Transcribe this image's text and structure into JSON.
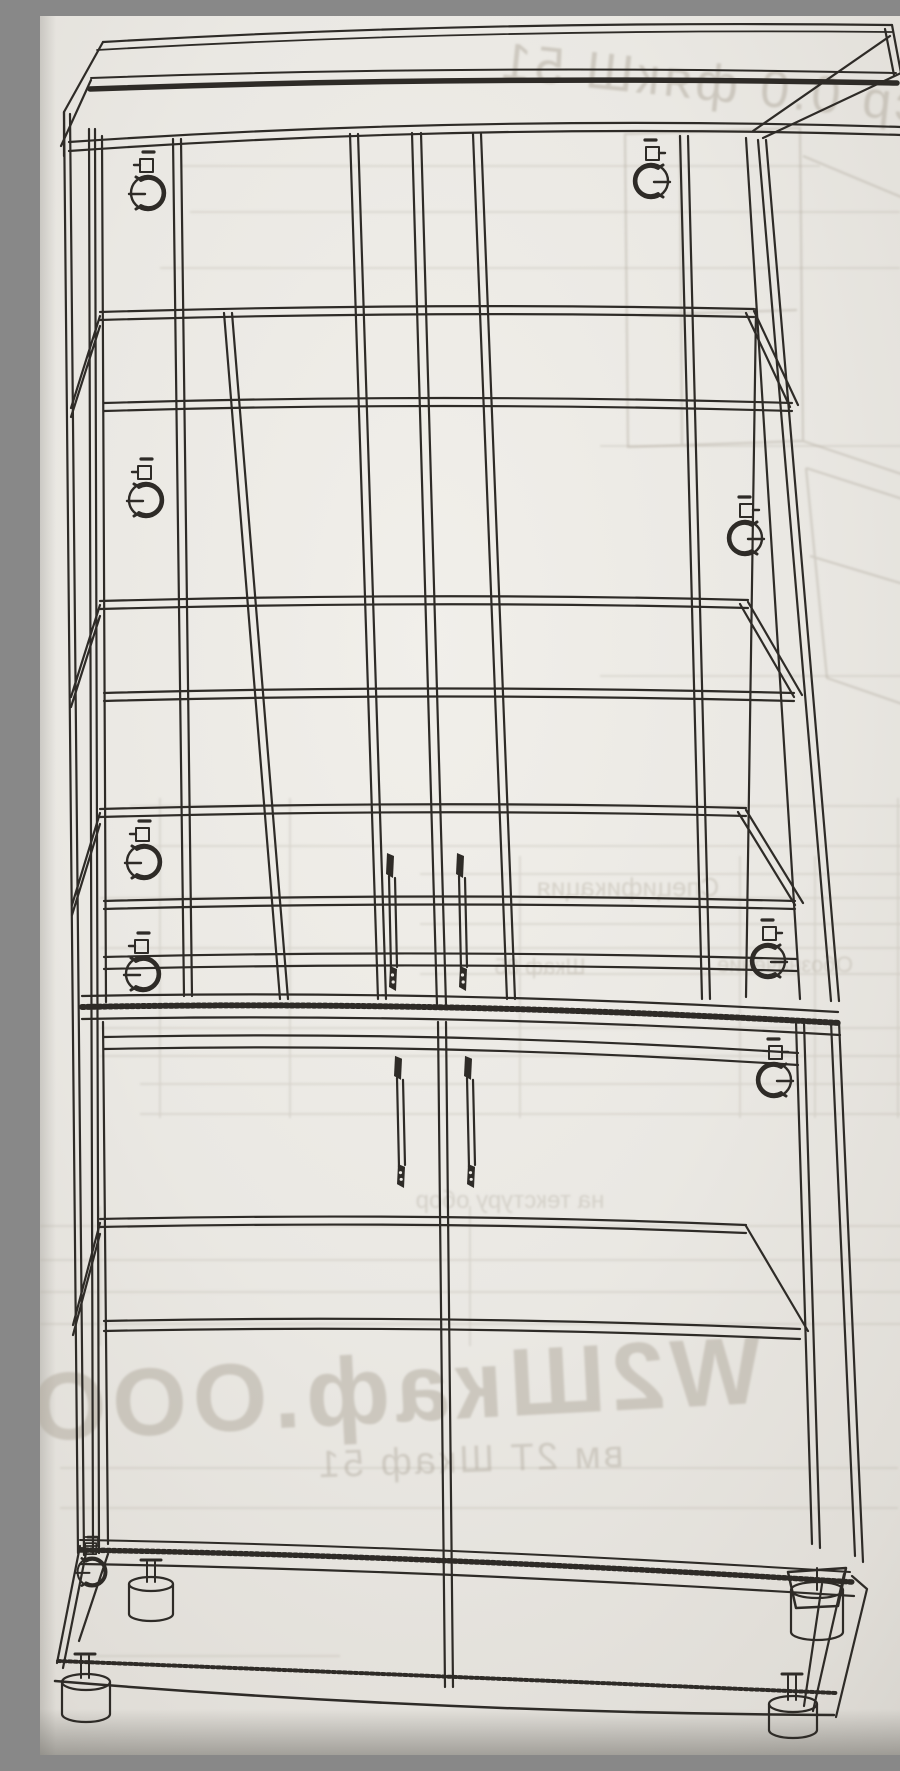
{
  "page": {
    "kind": "photographed furniture assembly drawing",
    "object": "tall two-section cabinet with glass doors, wireframe perspective view"
  },
  "palette": {
    "paper": "#EFEDE8",
    "paper_edge": "#D6D3CD",
    "photo_shadow": "#B9B6B0",
    "ink": "#2E2B27",
    "bleed_ink": "#AFA89B"
  },
  "bleed_through": {
    "top_right_text": "ср 0.0 фякШ 51",
    "bottom_text_large": "W2Шкаф.ООО",
    "bottom_text_small": "вм 2Т Шкаф 51",
    "table_word_1": "Спецификация",
    "table_word_2": "Обозначение",
    "table_word_3": "Шкаф 85",
    "table_word_4": "на текстуру обор"
  }
}
